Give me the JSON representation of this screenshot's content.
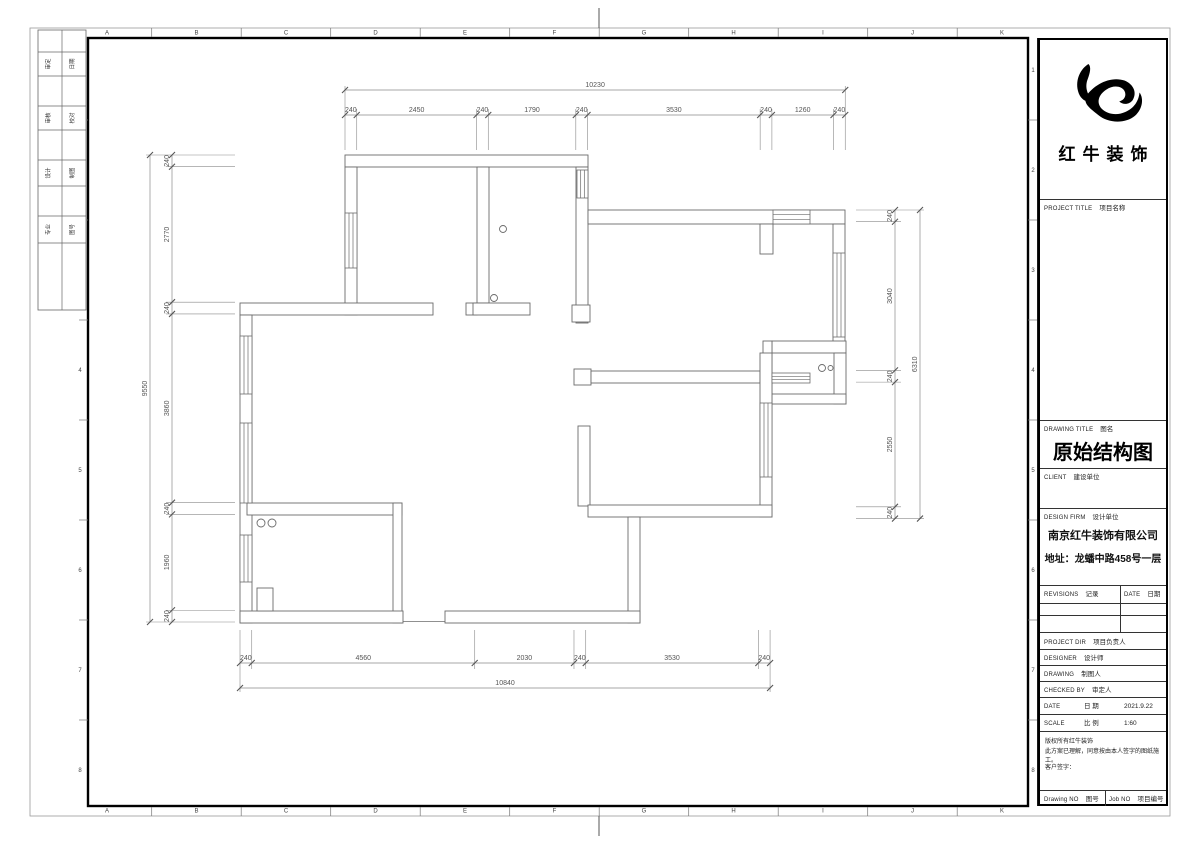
{
  "sheet": {
    "grid_letters": [
      "A",
      "B",
      "C",
      "D",
      "E",
      "F",
      "G",
      "H",
      "I",
      "J",
      "K"
    ],
    "grid_numbers": [
      "1",
      "2",
      "3",
      "4",
      "5",
      "6",
      "7",
      "8"
    ],
    "left_stub_rows": [
      [
        "审定",
        "日期"
      ],
      [
        "审核",
        "校对"
      ],
      [
        "设计",
        "制图"
      ],
      [
        "专业",
        "图号"
      ]
    ]
  },
  "title_block": {
    "brand": "红牛装饰",
    "project_title": {
      "en": "PROJECT TITLE",
      "cn": "项目名称"
    },
    "drawing_title": {
      "en": "DRAWING TITLE",
      "cn": "图名",
      "value": "原始结构图"
    },
    "client": {
      "en": "CLIENT",
      "cn": "建设单位"
    },
    "design_firm": {
      "en": "DESIGN FIRM",
      "cn": "设计单位",
      "company": "南京红牛装饰有限公司",
      "address": "地址：龙蟠中路458号一层"
    },
    "revisions": {
      "en": "REVISIONS",
      "cn": "记录"
    },
    "date_header": {
      "en": "DATE",
      "cn": "日期"
    },
    "project_dir": {
      "en": "PROJECT DIR",
      "cn": "项目负责人"
    },
    "designer": {
      "en": "DESIGNER",
      "cn": "设计师"
    },
    "drawing_by": {
      "en": "DRAWING",
      "cn": "制图人"
    },
    "checked_by": {
      "en": "CHECKED BY",
      "cn": "审定人"
    },
    "date_row": {
      "en": "DATE",
      "cn": "日 期",
      "value": "2021.9.22"
    },
    "scale_row": {
      "en": "SCALE",
      "cn": "比 例",
      "value": "1:60"
    },
    "copyright_line1": "版权所有红牛装饰",
    "copyright_line2": "此方案已理解，同意按由本人签字的图纸施工。",
    "customer_sign": "客户签字：",
    "drawing_no": {
      "en": "Drawing NO",
      "cn": "图号"
    },
    "job_no": {
      "en": "Job NO",
      "cn": "项目编号"
    }
  },
  "plan": {
    "scale_px_per_mm": 0.0489,
    "dims": [
      {
        "name": "top",
        "orient": "h",
        "origin": 345,
        "line": 115,
        "totalLine": 90,
        "total": "10230",
        "segments": [
          240,
          2450,
          240,
          1790,
          240,
          3530,
          240,
          1260,
          240
        ],
        "extTo": 150
      },
      {
        "name": "bottom",
        "orient": "h",
        "origin": 240,
        "line": 663,
        "totalLine": 688,
        "total": "10840",
        "segments": [
          240,
          4560,
          2030,
          240,
          3530,
          240
        ],
        "extTo": 630
      },
      {
        "name": "left",
        "orient": "v",
        "origin": 155,
        "line": 172,
        "totalLine": 150,
        "total": "9550",
        "segments": [
          240,
          2770,
          240,
          3860,
          240,
          1960,
          240
        ],
        "extTo": 235
      },
      {
        "name": "right",
        "orient": "v",
        "origin": 210,
        "line": 895,
        "totalLine": 920,
        "total": "6310",
        "segments": [
          240,
          3040,
          240,
          2550,
          240
        ],
        "extTo": 856
      }
    ],
    "walls": [
      {
        "x": 345,
        "y": 155,
        "w": 243,
        "h": 12
      },
      {
        "x": 345,
        "y": 167,
        "w": 12,
        "h": 148
      },
      {
        "x": 240,
        "y": 303,
        "w": 193,
        "h": 12
      },
      {
        "x": 466,
        "y": 303,
        "w": 11,
        "h": 12
      },
      {
        "x": 477,
        "y": 167,
        "w": 12,
        "h": 136
      },
      {
        "x": 473,
        "y": 303,
        "w": 57,
        "h": 12
      },
      {
        "x": 576,
        "y": 167,
        "w": 12,
        "h": 156
      },
      {
        "x": 572,
        "y": 305,
        "w": 18,
        "h": 17
      },
      {
        "x": 588,
        "y": 210,
        "w": 257,
        "h": 14
      },
      {
        "x": 760,
        "y": 224,
        "w": 13,
        "h": 30
      },
      {
        "x": 833,
        "y": 224,
        "w": 12,
        "h": 123
      },
      {
        "x": 772,
        "y": 341,
        "w": 74,
        "h": 12
      },
      {
        "x": 763,
        "y": 341,
        "w": 9,
        "h": 63
      },
      {
        "x": 834,
        "y": 353,
        "w": 12,
        "h": 51
      },
      {
        "x": 772,
        "y": 394,
        "w": 74,
        "h": 10
      },
      {
        "x": 574,
        "y": 369,
        "w": 17,
        "h": 16
      },
      {
        "x": 591,
        "y": 371,
        "w": 169,
        "h": 12
      },
      {
        "x": 760,
        "y": 353,
        "w": 12,
        "h": 164
      },
      {
        "x": 578,
        "y": 426,
        "w": 12,
        "h": 80
      },
      {
        "x": 588,
        "y": 505,
        "w": 184,
        "h": 12
      },
      {
        "x": 628,
        "y": 517,
        "w": 12,
        "h": 106
      },
      {
        "x": 240,
        "y": 315,
        "w": 12,
        "h": 308
      },
      {
        "x": 247,
        "y": 503,
        "w": 155,
        "h": 12
      },
      {
        "x": 393,
        "y": 503,
        "w": 9,
        "h": 120
      },
      {
        "x": 240,
        "y": 611,
        "w": 163,
        "h": 12
      },
      {
        "x": 445,
        "y": 611,
        "w": 195,
        "h": 12
      },
      {
        "x": 257,
        "y": 588,
        "w": 16,
        "h": 23
      }
    ],
    "windows": [
      {
        "x": 345,
        "y": 213,
        "w": 12,
        "h": 55
      },
      {
        "x": 577,
        "y": 170,
        "w": 11,
        "h": 28
      },
      {
        "x": 773,
        "y": 210,
        "w": 37,
        "h": 14
      },
      {
        "x": 833,
        "y": 253,
        "w": 12,
        "h": 84
      },
      {
        "x": 760,
        "y": 403,
        "w": 12,
        "h": 74
      },
      {
        "x": 240,
        "y": 336,
        "w": 12,
        "h": 58
      },
      {
        "x": 240,
        "y": 423,
        "w": 12,
        "h": 80
      },
      {
        "x": 240,
        "y": 535,
        "w": 12,
        "h": 47
      },
      {
        "x": 772,
        "y": 373,
        "w": 38,
        "h": 10
      }
    ],
    "circles": [
      {
        "cx": 503,
        "cy": 229,
        "r": 3.5
      },
      {
        "cx": 494,
        "cy": 298,
        "r": 3.5
      },
      {
        "cx": 261,
        "cy": 523,
        "r": 4
      },
      {
        "cx": 272,
        "cy": 523,
        "r": 4
      },
      {
        "cx": 822,
        "cy": 368,
        "r": 3.5
      },
      {
        "cx": 830.5,
        "cy": 368,
        "r": 2.5
      }
    ],
    "extra_lines": [
      [
        403,
        621.5,
        445,
        621.5
      ]
    ]
  }
}
